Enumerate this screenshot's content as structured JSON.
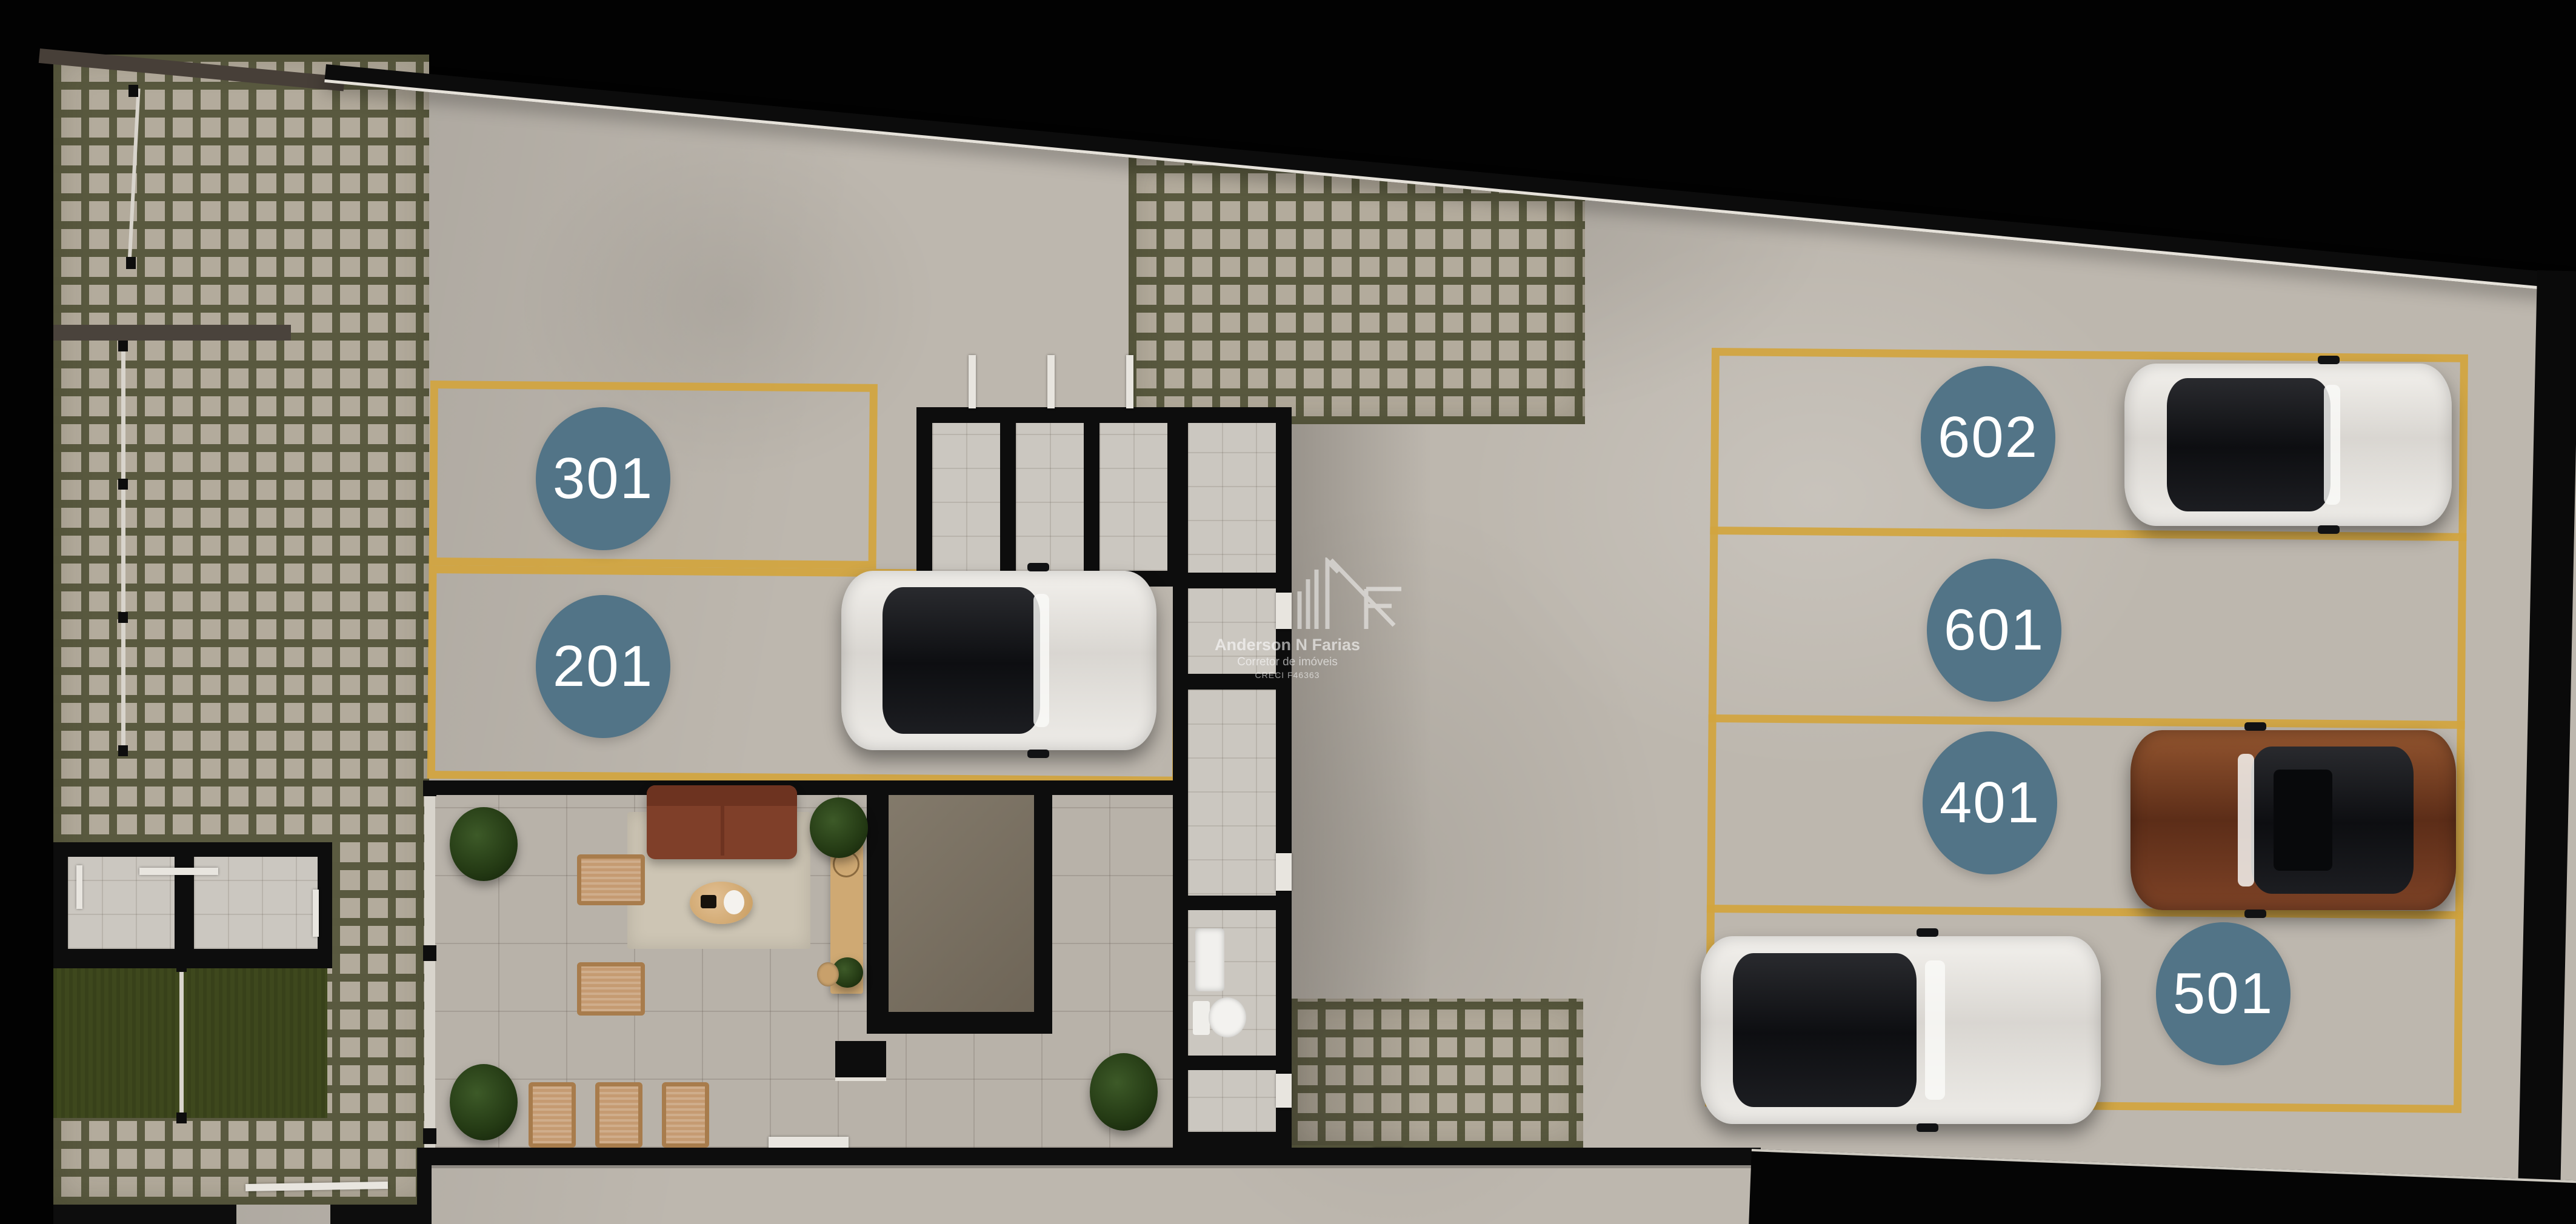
{
  "watermark": {
    "logo": "anf-monogram-logo",
    "name": "Anderson N Farias",
    "role": "Corretor de imóveis",
    "license": "CRECI F46363"
  },
  "plan": {
    "description": "Top-down 3D render of a condominium ground floor: paver courtyard, lobby lounge, storage stalls, bathroom and numbered parking spaces",
    "spots": [
      {
        "label": "301",
        "occupied": false
      },
      {
        "label": "201",
        "occupied": true,
        "car": "white-hatchback"
      },
      {
        "label": "602",
        "occupied": true,
        "car": "white-hatchback"
      },
      {
        "label": "601",
        "occupied": false
      },
      {
        "label": "401",
        "occupied": true,
        "car": "brown-suv"
      },
      {
        "label": "501",
        "occupied": true,
        "car": "white-sedan"
      }
    ],
    "colors": {
      "background": "#000000",
      "concrete": "#bdb7ae",
      "parking_line": "#d2a53e",
      "spot_badge": "#527487",
      "badge_text": "#ffffff",
      "paver_tile": "#b3ab9c",
      "paver_grout": "#59593f",
      "lawn": "#3e481d",
      "wall": "#0d0d0d"
    }
  }
}
